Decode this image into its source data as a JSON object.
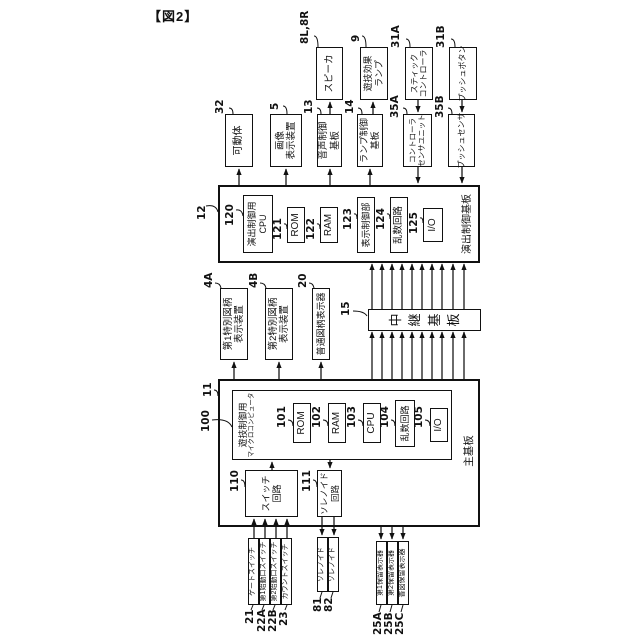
{
  "caption": "【図2】",
  "boxes": [
    {
      "id": "effect-board",
      "ref": "12",
      "lines": [
        "演出制御基板"
      ]
    },
    {
      "id": "effect-cpu",
      "ref": "120",
      "lines": [
        "演出制御用",
        "CPU"
      ]
    },
    {
      "id": "effect-rom",
      "ref": "121",
      "lines": [
        "ROM"
      ]
    },
    {
      "id": "effect-ram",
      "ref": "122",
      "lines": [
        "RAM"
      ]
    },
    {
      "id": "display-control",
      "ref": "123",
      "lines": [
        "表示制御部"
      ]
    },
    {
      "id": "effect-random",
      "ref": "124",
      "lines": [
        "乱数回路"
      ]
    },
    {
      "id": "effect-io",
      "ref": "125",
      "lines": [
        "I/O"
      ]
    },
    {
      "id": "main-board",
      "ref": "11",
      "lines": [
        "主基板"
      ]
    },
    {
      "id": "microcomputer",
      "ref": "100",
      "lines": [
        "遊技制御用",
        "マイクロコンピュータ"
      ]
    },
    {
      "id": "main-rom",
      "ref": "101",
      "lines": [
        "ROM"
      ]
    },
    {
      "id": "main-ram",
      "ref": "102",
      "lines": [
        "RAM"
      ]
    },
    {
      "id": "main-cpu",
      "ref": "103",
      "lines": [
        "CPU"
      ]
    },
    {
      "id": "main-random",
      "ref": "104",
      "lines": [
        "乱数回路"
      ]
    },
    {
      "id": "main-io",
      "ref": "105",
      "lines": [
        "I/O"
      ]
    },
    {
      "id": "switch-circuit",
      "ref": "110",
      "lines": [
        "スイッチ",
        "回路"
      ]
    },
    {
      "id": "solenoid-circuit",
      "ref": "111",
      "lines": [
        "ソレノイド",
        "回路"
      ]
    },
    {
      "id": "relay-board",
      "ref": "15",
      "lines": [
        "中継基板"
      ]
    },
    {
      "id": "special-symbol-display-1",
      "ref": "4A",
      "lines": [
        "第1特別図柄",
        "表示装置"
      ]
    },
    {
      "id": "special-symbol-display-2",
      "ref": "4B",
      "lines": [
        "第2特別図柄",
        "表示装置"
      ]
    },
    {
      "id": "normal-symbol-display",
      "ref": "20",
      "lines": [
        "普通図柄表示器"
      ]
    },
    {
      "id": "movable-body",
      "ref": "32",
      "lines": [
        "可動体"
      ]
    },
    {
      "id": "image-display",
      "ref": "5",
      "lines": [
        "画像",
        "表示装置"
      ]
    },
    {
      "id": "sound-control-board",
      "ref": "13",
      "lines": [
        "音声制御",
        "基板"
      ]
    },
    {
      "id": "lamp-control-board",
      "ref": "14",
      "lines": [
        "ランプ制御",
        "基板"
      ]
    },
    {
      "id": "controller-sensor-unit",
      "ref": "35A",
      "lines": [
        "コントローラ",
        "センサユニット"
      ]
    },
    {
      "id": "push-sensor",
      "ref": "35B",
      "lines": [
        "プッシュセンサ"
      ]
    },
    {
      "id": "speaker",
      "ref": "8L,8R",
      "lines": [
        "スピーカ"
      ]
    },
    {
      "id": "game-effect-lamp",
      "ref": "9",
      "lines": [
        "遊技効果",
        "ランプ"
      ]
    },
    {
      "id": "stick-controller",
      "ref": "31A",
      "lines": [
        "スティック",
        "コントローラ"
      ]
    },
    {
      "id": "push-button",
      "ref": "31B",
      "lines": [
        "プッシュボタン"
      ]
    },
    {
      "id": "gate-switch",
      "ref": "21",
      "lines": [
        "ゲートスイッチ"
      ]
    },
    {
      "id": "first-start-switch",
      "ref": "22A",
      "lines": [
        "第1始動口スイッチ"
      ]
    },
    {
      "id": "second-start-switch",
      "ref": "22B",
      "lines": [
        "第2始動口スイッチ"
      ]
    },
    {
      "id": "count-switch",
      "ref": "23",
      "lines": [
        "カウントスイッチ"
      ]
    },
    {
      "id": "solenoid-81",
      "ref": "81",
      "lines": [
        "ソレノイド"
      ]
    },
    {
      "id": "solenoid-82",
      "ref": "82",
      "lines": [
        "ソレノイド"
      ]
    },
    {
      "id": "first-hold-display",
      "ref": "25A",
      "lines": [
        "第1保留表示器"
      ]
    },
    {
      "id": "second-hold-display",
      "ref": "25B",
      "lines": [
        "第2保留表示器"
      ]
    },
    {
      "id": "normal-hold-display",
      "ref": "25C",
      "lines": [
        "普図保留表示器"
      ]
    }
  ]
}
